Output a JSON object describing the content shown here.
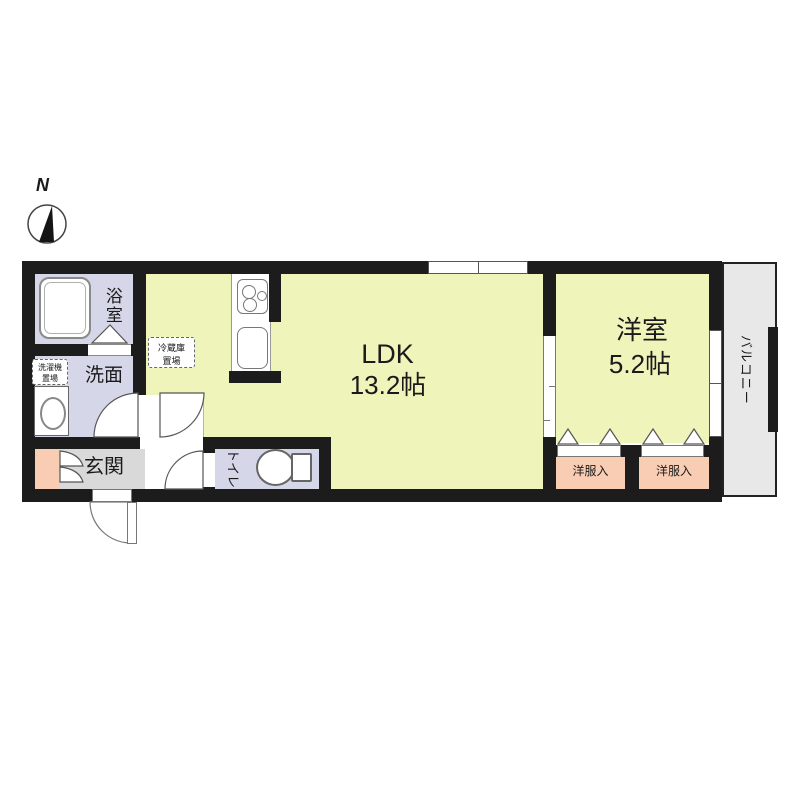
{
  "title": "apartment-floor-plan",
  "compass": {
    "north_label": "N"
  },
  "rooms": {
    "bathroom": {
      "name": "浴室"
    },
    "washroom": {
      "name": "洗面"
    },
    "entrance": {
      "name": "玄関"
    },
    "toilet": {
      "name": "トイレ"
    },
    "ldk": {
      "name": "LDK",
      "area": "13.2帖"
    },
    "western_room": {
      "name": "洋室",
      "area": "5.2帖"
    },
    "closet_left": {
      "name": "洋服入"
    },
    "closet_right": {
      "name": "洋服入"
    },
    "balcony": {
      "name": "バルコニー"
    }
  },
  "annotations": {
    "fridge_space": {
      "line1": "冷蔵庫",
      "line2": "置場"
    },
    "washer_space": {
      "line1": "洗濯機",
      "line2": "置場"
    }
  },
  "colors": {
    "wall": "#1c1c1c",
    "room_yellow": "#eff4ba",
    "room_lavender": "#d5d7e9",
    "room_salmon": "#f8cdb4",
    "room_gray": "#d9d9d9",
    "balcony_gray": "#e8e8e8"
  }
}
